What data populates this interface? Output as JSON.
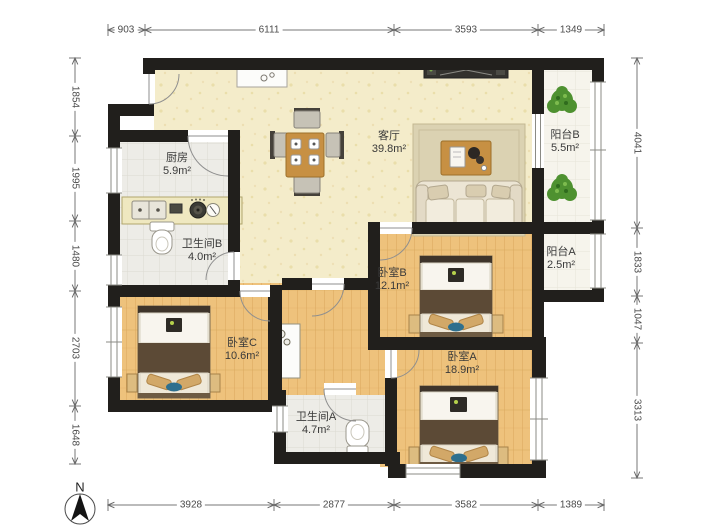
{
  "compass": {
    "label": "N"
  },
  "rooms": {
    "living": {
      "name": "客厅",
      "area": "39.8m²"
    },
    "kitchen": {
      "name": "厨房",
      "area": "5.9m²"
    },
    "bath_b": {
      "name": "卫生间B",
      "area": "4.0m²"
    },
    "balcony_b": {
      "name": "阳台B",
      "area": "5.5m²"
    },
    "balcony_a": {
      "name": "阳台A",
      "area": "2.5m²"
    },
    "bed_b": {
      "name": "卧室B",
      "area": "12.1m²"
    },
    "bed_c": {
      "name": "卧室C",
      "area": "10.6m²"
    },
    "bed_a": {
      "name": "卧室A",
      "area": "18.9m²"
    },
    "bath_a": {
      "name": "卫生间A",
      "area": "4.7m²"
    }
  },
  "dimensions": {
    "top": [
      "903",
      "6111",
      "3593",
      "1349"
    ],
    "bottom": [
      "3928",
      "2877",
      "3582",
      "1389"
    ],
    "left": [
      "1854",
      "1995",
      "1480",
      "2703",
      "1648"
    ],
    "right": [
      "4041",
      "1833",
      "1047",
      "3313"
    ]
  },
  "colors": {
    "wall": "#211f1c",
    "wood_floor": "#eec27c",
    "living_floor": "#f4ecca",
    "tile_floor": "#edece7",
    "balcony_floor": "#f6f4ec",
    "bed_blanket": "#5c4a36",
    "rug": "#dbd2b2",
    "table": "#c79043",
    "plant": "#4e9130",
    "dimension_text": "#4a4a4a"
  }
}
